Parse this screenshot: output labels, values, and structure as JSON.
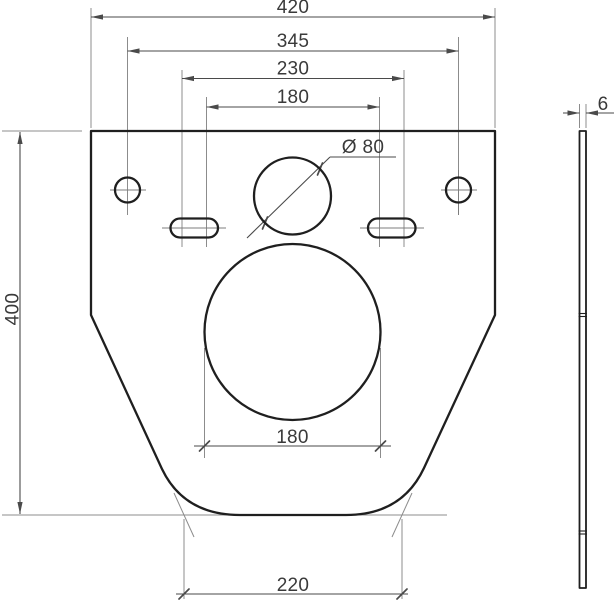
{
  "front_view": {
    "width_total": "420",
    "width_hole_centers": "345",
    "width_slot_outer": "230",
    "width_slot_inner": "180",
    "height_total": "400",
    "opening_diameter": "Ø 80",
    "opening_width": "180",
    "width_bottom": "220"
  },
  "side_view": {
    "thickness": "6"
  },
  "colors": {
    "outline": "#1f1f1f",
    "dimension": "#4a4a4a",
    "extension": "#8c8c8c",
    "centerline": "#7d7d7d",
    "text": "#3a3a3a",
    "background": "#ffffff"
  }
}
